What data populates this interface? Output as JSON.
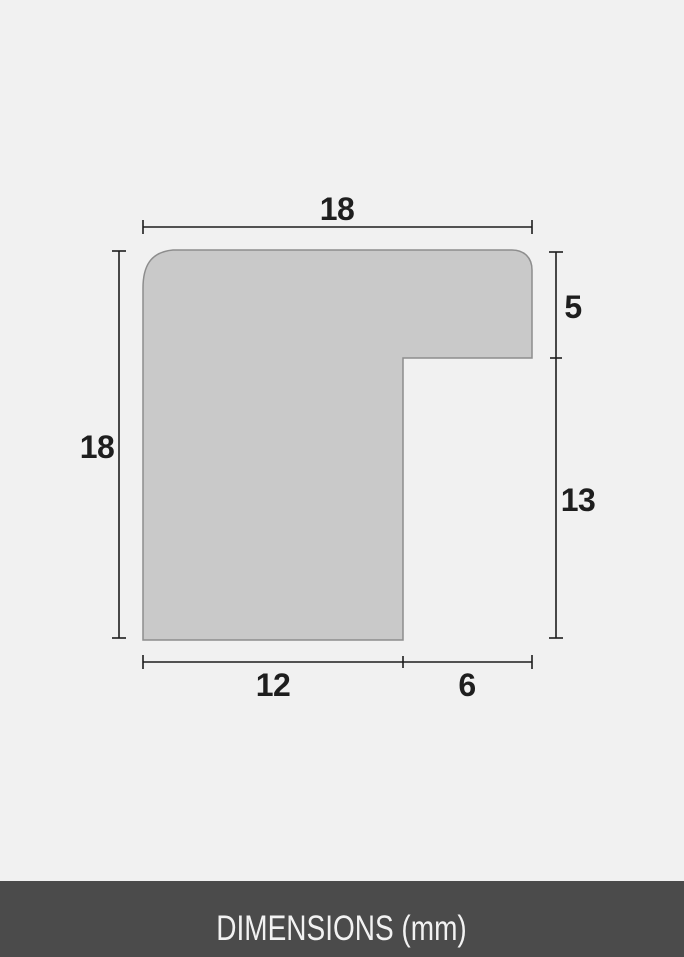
{
  "page": {
    "background_color": "#f1f1f1"
  },
  "diagram": {
    "description": "frame-moulding-profile-cross-section",
    "shape_fill_color": "#c9c9c9",
    "shape_stroke_color": "#8d8d8d",
    "dimension_line_color": "#1e1e1e",
    "labels": {
      "top_width": "18",
      "left_height": "18",
      "right_top": "5",
      "right_bottom": "13",
      "bottom_left": "12",
      "bottom_right": "6"
    },
    "values_mm": {
      "top_width": 18,
      "left_height": 18,
      "right_top": 5,
      "right_bottom": 13,
      "bottom_left": 12,
      "bottom_right": 6
    }
  },
  "footer": {
    "label": "DIMENSIONS (mm)",
    "background_color": "#4b4b4b",
    "text_color": "#f2f2f2"
  }
}
